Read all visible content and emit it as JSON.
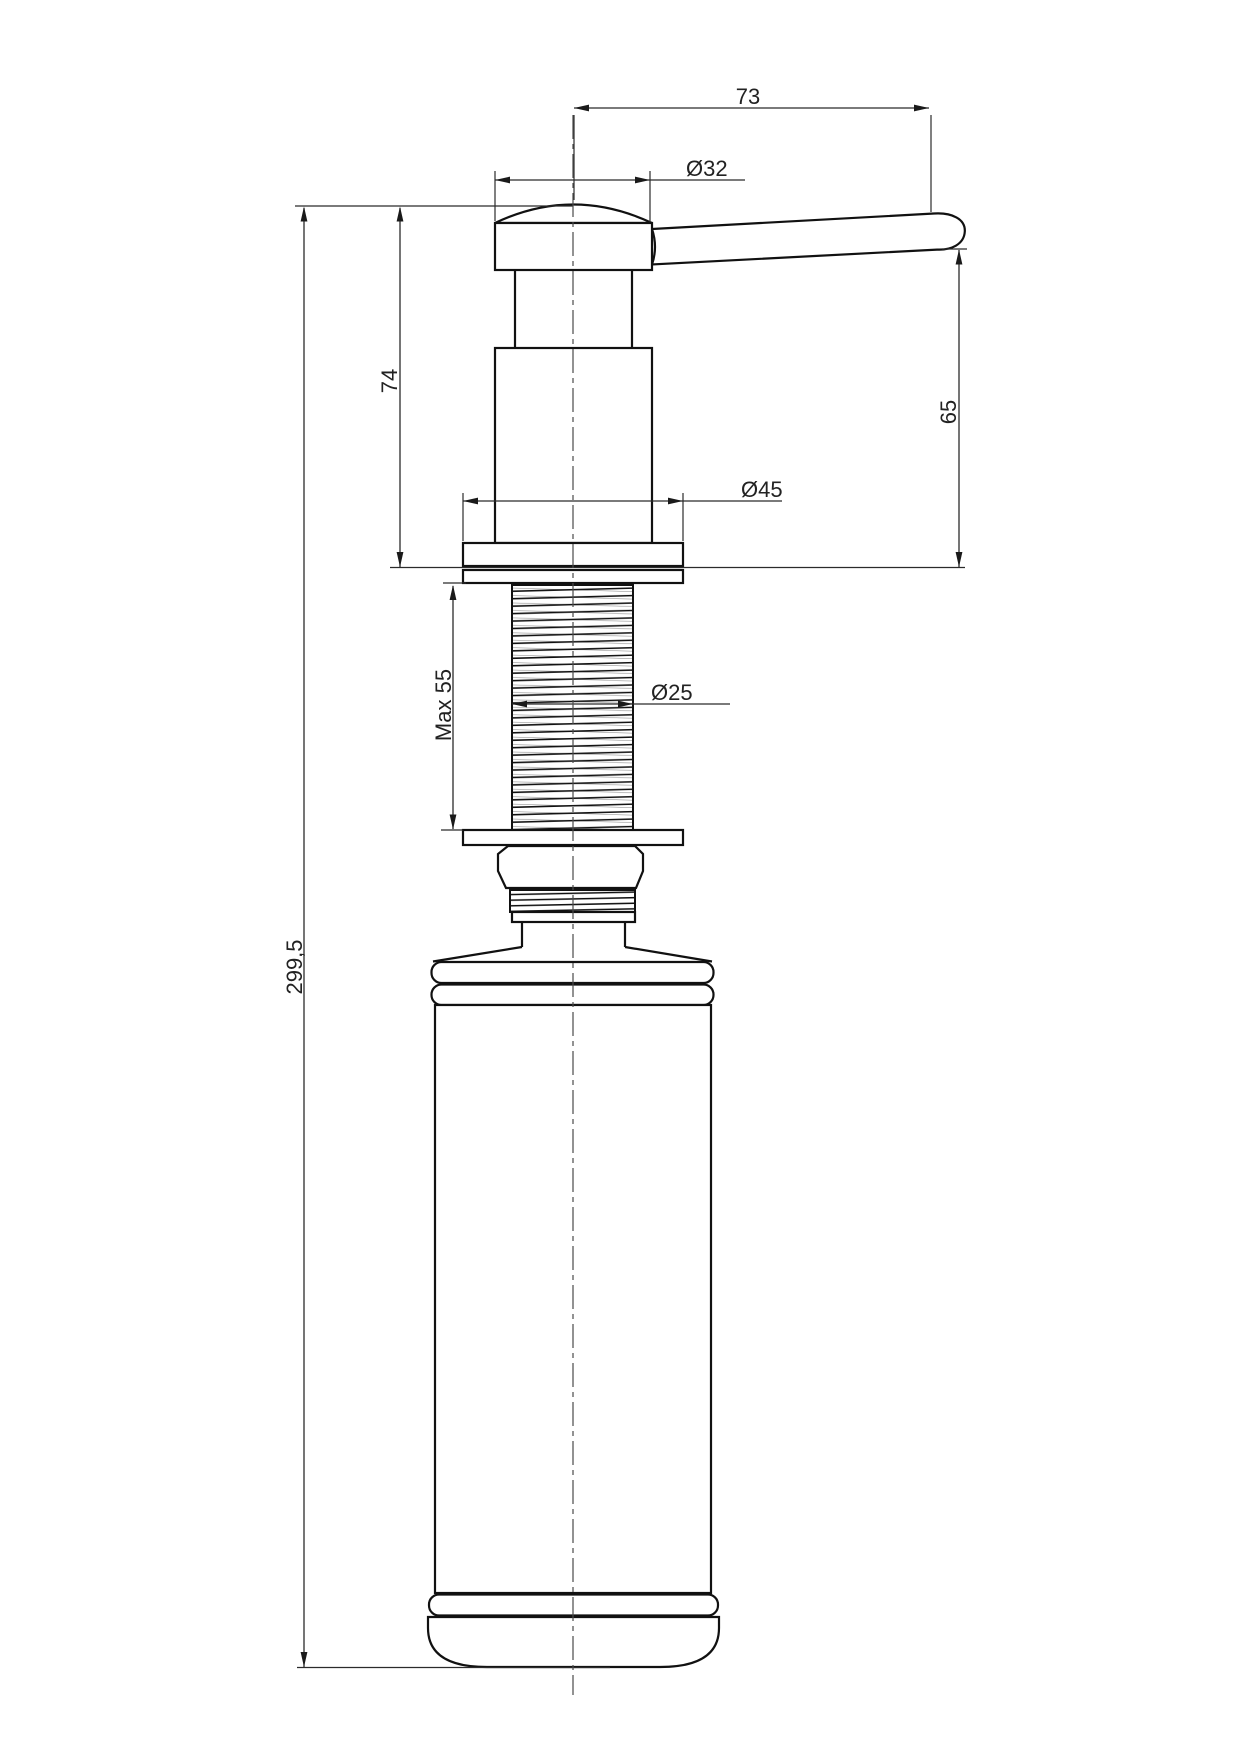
{
  "page": {
    "background": "#ffffff"
  },
  "drawing": {
    "kind": "technical-drawing",
    "colors": {
      "outline": "#111111",
      "dimension": "#2b2b2b",
      "centerline": "#4a4a4a",
      "background": "#ffffff"
    },
    "labels": {
      "spout_length": "73",
      "cap_diameter": "Ø32",
      "pump_height": "74",
      "spout_height": "65",
      "flange_diameter": "Ø45",
      "thread_length": "Max 55",
      "thread_diameter": "Ø25",
      "total_height": "299,5"
    }
  }
}
